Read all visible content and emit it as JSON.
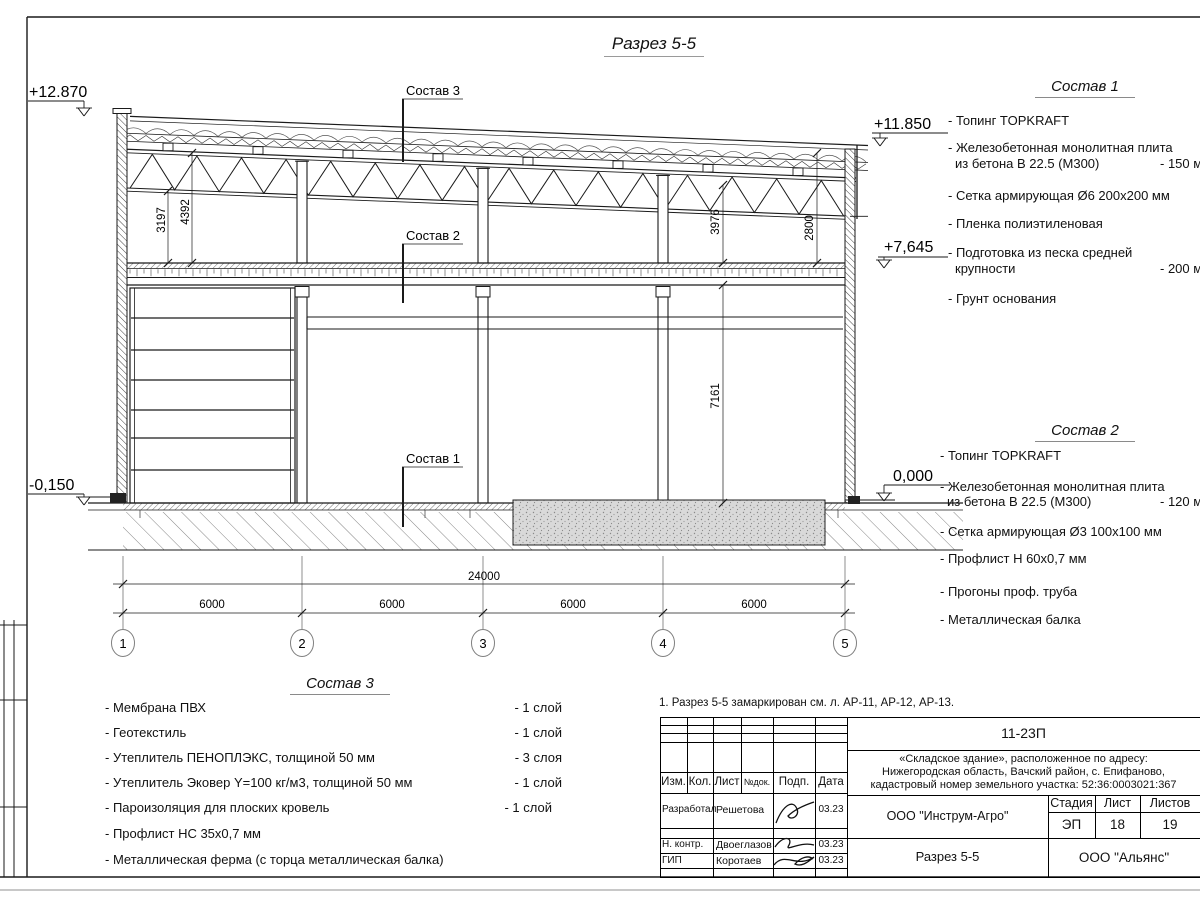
{
  "page_title": "Разрез 5-5",
  "note": "1. Разрез 5-5 замаркирован см. л. АР-11, АР-12, АР-13.",
  "drawing": {
    "callouts": {
      "c1": "Состав 1",
      "c2": "Состав 2",
      "c3": "Состав 3"
    },
    "elevations": {
      "e12870": "+12.870",
      "e11850": "+11.850",
      "e7645": "+7,645",
      "e0000": "0,000",
      "em0150": "-0,150"
    },
    "dims": {
      "d3197": "3197",
      "d4392": "4392",
      "d3976": "3976",
      "d2800": "2800",
      "d7161": "7161",
      "total": "24000",
      "bay": "6000"
    },
    "axes": [
      "1",
      "2",
      "3",
      "4",
      "5"
    ]
  },
  "sostav1": {
    "heading": "Состав 1",
    "items": [
      {
        "l1": "- Топинг TOPKRAFT"
      },
      {
        "l1": "- Железобетонная  монолитная плита",
        "l2": "из бетона  В 22.5 (М300)",
        "v": "- 150 мм"
      },
      {
        "l1": "- Сетка армирующая Ø6 200х200 мм"
      },
      {
        "l1": "- Пленка полиэтиленовая"
      },
      {
        "l1": "- Подготовка из песка средней",
        "l2": "крупности",
        "v": "- 200 мм"
      },
      {
        "l1": "- Грунт основания"
      }
    ]
  },
  "sostav2": {
    "heading": "Состав 2",
    "items": [
      {
        "l1": "- Топинг TOPKRAFT"
      },
      {
        "l1": "- Железобетонная  монолитная плита",
        "l2": "из бетона  В 22.5 (М300)",
        "v": "- 120 мм"
      },
      {
        "l1": "- Сетка армирующая Ø3 100х100 мм"
      },
      {
        "l1": "- Профлист Н 60х0,7 мм"
      },
      {
        "l1": "- Прогоны проф. труба"
      },
      {
        "l1": "- Металлическая балка"
      }
    ]
  },
  "sostav3": {
    "heading": "Состав 3",
    "items": [
      {
        "l1": "- Мембрана ПВХ",
        "v": "- 1 слой"
      },
      {
        "l1": "- Геотекстиль",
        "v": "- 1 слой"
      },
      {
        "l1": "- Утеплитель ПЕНОПЛЭКС, толщиной 50 мм",
        "v": "- 3 слоя"
      },
      {
        "l1": "- Утеплитель Эковер Y=100 кг/м3, толщиной 50 мм",
        "v": "- 1 слой"
      },
      {
        "l1": "- Пароизоляция для плоских кровель",
        "v": "- 1 слой"
      },
      {
        "l1": "- Профлист НС 35х0,7 мм"
      },
      {
        "l1": "- Металлическая ферма (с торца металлическая балка)"
      }
    ]
  },
  "titleblock": {
    "code": "11-23П",
    "object_lines": [
      "«Складское здание», расположенное по адресу:",
      "Нижегородская область, Вачский район, с. Епифаново,",
      "кадастровый номер земельного участка: 52:36:0003021:367"
    ],
    "headers": {
      "izm": "Изм.",
      "kol": "Кол.",
      "list": "Лист",
      "ndok": "№док.",
      "podp": "Подп.",
      "data": "Дата"
    },
    "rows": [
      {
        "role": "Разработал",
        "name": "Решетова",
        "date": "03.23"
      },
      {
        "role": "Н. контр.",
        "name": "Двоеглазов",
        "date": "03.23"
      },
      {
        "role": "ГИП",
        "name": "Коротаев",
        "date": "03.23"
      }
    ],
    "org": "ООО \"Инструм-Агро\"",
    "stage_label": "Стадия",
    "list_label": "Лист",
    "listov_label": "Листов",
    "stage": "ЭП",
    "list": "18",
    "listov": "19",
    "section": "Разрез 5-5",
    "firm": "ООО \"Альянс\""
  }
}
